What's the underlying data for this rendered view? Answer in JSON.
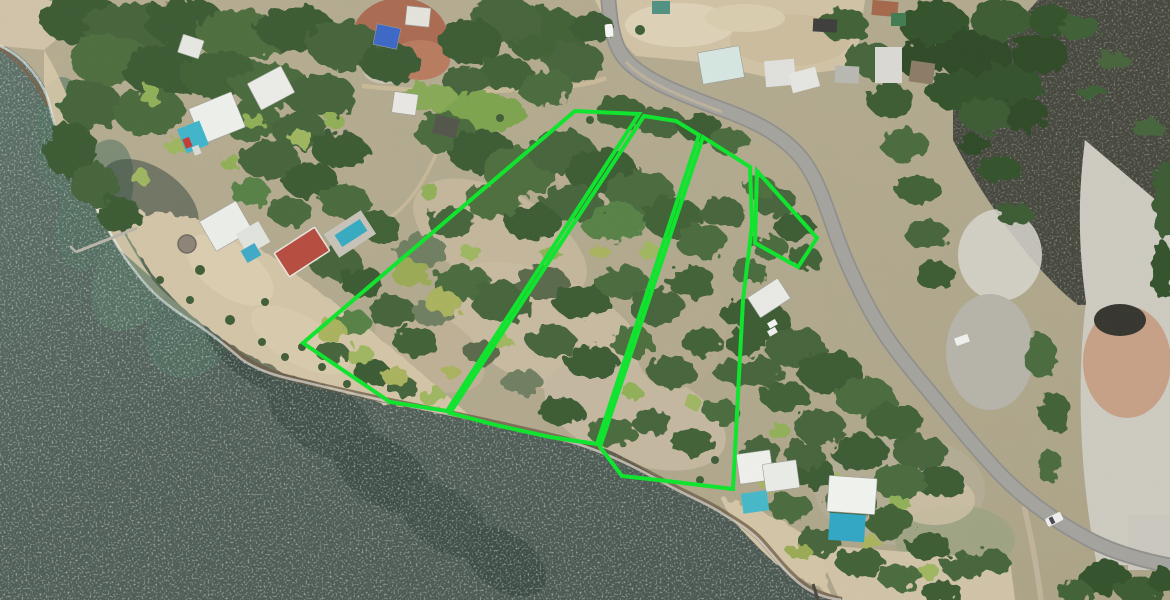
{
  "scene": {
    "type": "aerial-drone-photo",
    "description": "Aerial drone photograph of oceanfront land parcels outlined in bright green, bordered by a sandy beach and sea on the west, a curving coastal road on the east, beach villas with pools, and a mangrove lagoon in the northeast",
    "width_px": 1170,
    "height_px": 600
  },
  "overlay": {
    "boundary_color": "#0ce32b",
    "boundary_stroke_px": 4,
    "parcels": [
      {
        "id": "parcel-1",
        "points": [
          [
            575,
            111
          ],
          [
            639,
            114
          ],
          [
            447,
            411
          ],
          [
            390,
            402
          ],
          [
            303,
            343
          ]
        ]
      },
      {
        "id": "parcel-2",
        "points": [
          [
            644,
            116
          ],
          [
            676,
            121
          ],
          [
            699,
            135
          ],
          [
            597,
            444
          ],
          [
            550,
            437
          ],
          [
            500,
            426
          ],
          [
            450,
            413
          ]
        ]
      },
      {
        "id": "parcel-3",
        "points": [
          [
            703,
            137
          ],
          [
            750,
            167
          ],
          [
            752,
            225
          ],
          [
            743,
            300
          ],
          [
            733,
            489
          ],
          [
            667,
            481
          ],
          [
            622,
            476
          ],
          [
            600,
            447
          ]
        ]
      },
      {
        "id": "parcel-4",
        "points": [
          [
            757,
            171
          ],
          [
            817,
            238
          ],
          [
            798,
            267
          ],
          [
            755,
            243
          ]
        ]
      }
    ]
  },
  "environment": {
    "sea_color": "#4e5d55",
    "shallow_color": "#4f7260",
    "sand_color": "#d2c3a5",
    "scrub_color": "#b3a98e",
    "road_color": "#a3a29d",
    "lagoon_color": "#44463c",
    "construction_dirt_color": "#a96a50",
    "tree_colors": [
      "#33512c",
      "#3f6034",
      "#4a6a3c",
      "#568044"
    ]
  },
  "landmarks": [
    {
      "name": "wooden-pier",
      "x": 105,
      "y": 240
    },
    {
      "name": "beachfront-villa-with-pool-north",
      "x": 215,
      "y": 120
    },
    {
      "name": "hip-roof-villa-north",
      "x": 270,
      "y": 90
    },
    {
      "name": "villa-with-pool-and-round-hut",
      "x": 225,
      "y": 230
    },
    {
      "name": "red-roof-building",
      "x": 300,
      "y": 260
    },
    {
      "name": "lap-pool-with-deck",
      "x": 350,
      "y": 237
    },
    {
      "name": "construction-site-blue-roof",
      "x": 398,
      "y": 38
    },
    {
      "name": "white-a-frame-cottage",
      "x": 405,
      "y": 103
    },
    {
      "name": "dark-roof-hut",
      "x": 445,
      "y": 127
    },
    {
      "name": "dirt-lot-north",
      "x": 730,
      "y": 35
    },
    {
      "name": "pale-teal-roof-house",
      "x": 720,
      "y": 65
    },
    {
      "name": "coastal-road",
      "x": 860,
      "y": 290
    },
    {
      "name": "white-car-on-road-north",
      "x": 610,
      "y": 30
    },
    {
      "name": "white-car-on-road-south",
      "x": 1054,
      "y": 521
    },
    {
      "name": "roadside-house-grey-roof",
      "x": 769,
      "y": 299
    },
    {
      "name": "beach-house-with-pool-south",
      "x": 768,
      "y": 470
    },
    {
      "name": "white-villa-with-pool-southeast",
      "x": 852,
      "y": 505
    },
    {
      "name": "mangrove-forest",
      "x": 985,
      "y": 60
    },
    {
      "name": "mangrove-lagoon",
      "x": 1090,
      "y": 130
    },
    {
      "name": "dry-flats-east",
      "x": 1120,
      "y": 350
    },
    {
      "name": "big-beach-west",
      "x": 250,
      "y": 300
    },
    {
      "name": "sea-southwest",
      "x": 300,
      "y": 480
    }
  ]
}
